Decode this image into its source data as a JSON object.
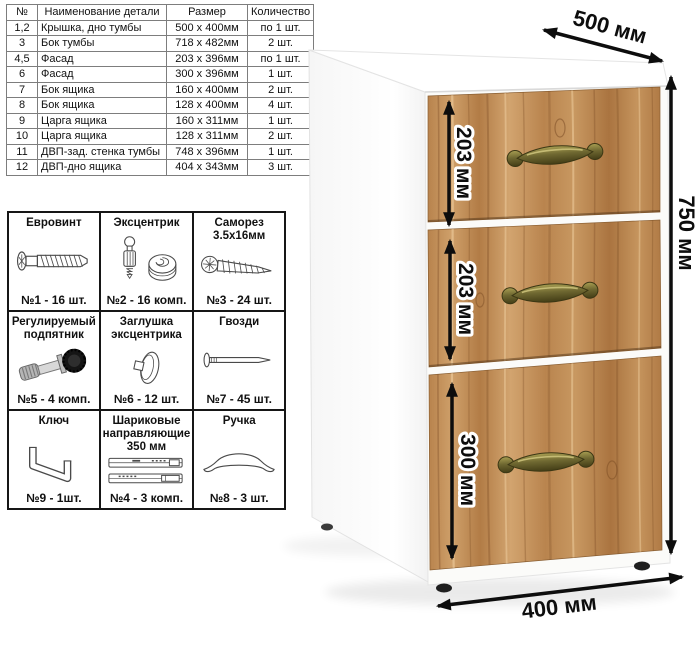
{
  "parts_table": {
    "headers": [
      "№",
      "Наименование детали",
      "Размер",
      "Количество"
    ],
    "rows": [
      {
        "num": "1,2",
        "name": "Крышка, дно тумбы",
        "size": "500 х 400мм",
        "qty": "по 1 шт."
      },
      {
        "num": "3",
        "name": "Бок тумбы",
        "size": "718 х 482мм",
        "qty": "2 шт."
      },
      {
        "num": "4,5",
        "name": "Фасад",
        "size": "203 х 396мм",
        "qty": "по 1 шт."
      },
      {
        "num": "6",
        "name": "Фасад",
        "size": "300 х 396мм",
        "qty": "1 шт."
      },
      {
        "num": "7",
        "name": "Бок ящика",
        "size": "160 х 400мм",
        "qty": "2 шт."
      },
      {
        "num": "8",
        "name": "Бок ящика",
        "size": "128 х 400мм",
        "qty": "4 шт."
      },
      {
        "num": "9",
        "name": "Царга ящика",
        "size": "160 х 311мм",
        "qty": "1 шт."
      },
      {
        "num": "10",
        "name": "Царга ящика",
        "size": "128 х 311мм",
        "qty": "2 шт."
      },
      {
        "num": "11",
        "name": "ДВП-зад. стенка тумбы",
        "size": "748 х 396мм",
        "qty": "1 шт."
      },
      {
        "num": "12",
        "name": "ДВП-дно ящика",
        "size": "404 х 343мм",
        "qty": "3 шт."
      }
    ]
  },
  "hardware": {
    "cells": [
      {
        "title": "Евровинт",
        "icon": "euro-screw-icon",
        "count": "№1 - 16 шт."
      },
      {
        "title": "Эксцентрик",
        "icon": "cam-lock-icon",
        "count": "№2 - 16 комп."
      },
      {
        "title": "Саморез 3.5х16мм",
        "icon": "self-tapping-screw-icon",
        "count": "№3 - 24 шт."
      },
      {
        "title": "Регулируемый подпятник",
        "icon": "adjustable-foot-icon",
        "count": "№5 - 4 комп."
      },
      {
        "title": "Заглушка эксцентрика",
        "icon": "cam-cap-icon",
        "count": "№6 - 12 шт."
      },
      {
        "title": "Гвозди",
        "icon": "nail-icon",
        "count": "№7 - 45 шт."
      },
      {
        "title": "Ключ",
        "icon": "hex-key-icon",
        "count": "№9 - 1шт."
      },
      {
        "title": "Шариковые направляющие 350 мм",
        "icon": "drawer-slides-icon",
        "count": "№4 - 3 комп."
      },
      {
        "title": "Ручка",
        "icon": "arch-handle-icon",
        "count": "№8 - 3 шт."
      }
    ]
  },
  "cabinet": {
    "dimensions": {
      "depth": "500 мм",
      "height": "750 мм",
      "width": "400 мм",
      "drawer1": "203 мм",
      "drawer2": "203 мм",
      "drawer3": "300 мм"
    },
    "colors": {
      "wood": "#bd8750",
      "wood_light": "#d2a46f",
      "wood_dark": "#a9743f",
      "body": "#ffffff",
      "handle_brass": "#6f6831",
      "dimension": "#0d0d0d"
    }
  }
}
